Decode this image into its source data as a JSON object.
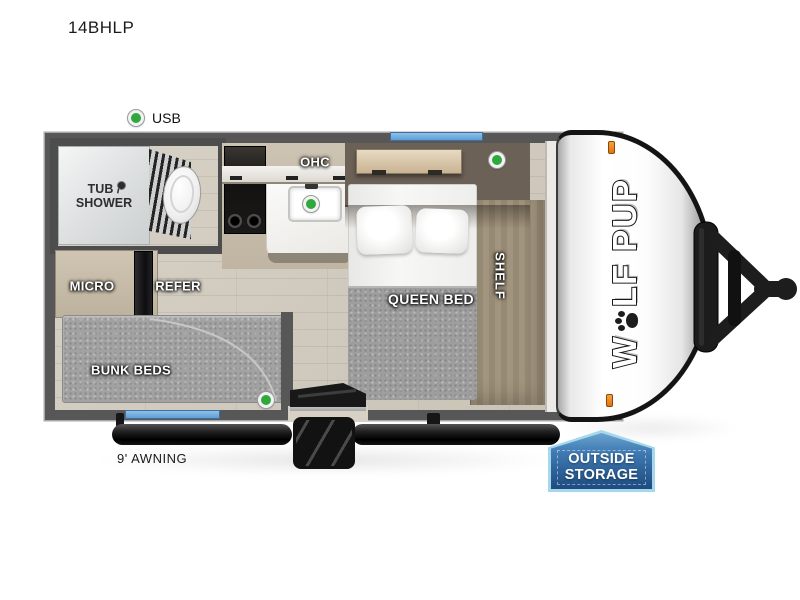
{
  "title": "14BHLP",
  "legend": {
    "usb": "USB"
  },
  "rooms": {
    "tub_shower_line1": "TUB /",
    "tub_shower_line2": "SHOWER",
    "ohc": "OHC",
    "micro": "MICRO",
    "refer": "REFER",
    "bunk_beds": "BUNK BEDS",
    "queen_bed": "QUEEN BED",
    "shelf": "SHELF"
  },
  "exterior": {
    "awning": "9' AWNING",
    "storage_line1": "OUTSIDE",
    "storage_line2": "STORAGE",
    "brand_prefix": "W",
    "brand_mid": "LF",
    "brand_suffix": "PUP"
  },
  "colors": {
    "wall": "#575757",
    "window_blue": "#6aa9de",
    "usb_green": "#2fa83c",
    "badge_border": "#a5d8ec",
    "badge_fill": "#1d4b80",
    "marker_orange": "#e8821e"
  }
}
